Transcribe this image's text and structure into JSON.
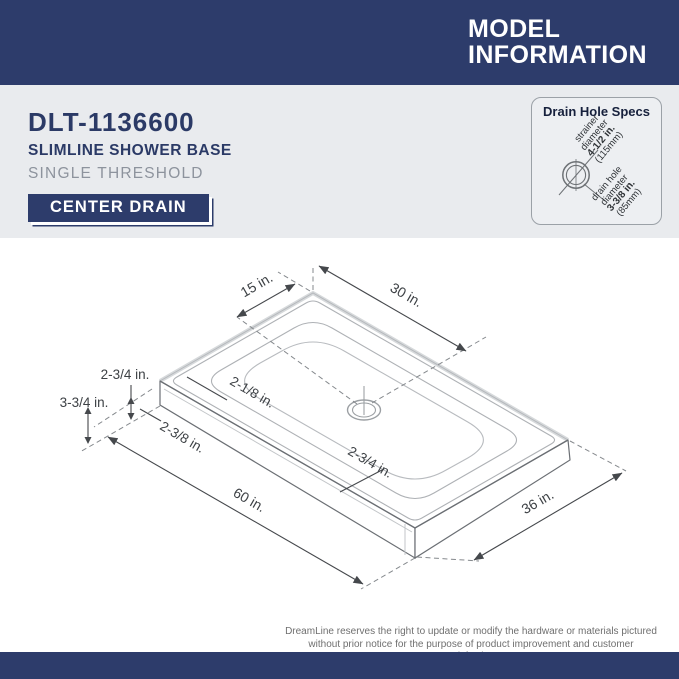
{
  "header": {
    "title_line1": "MODEL",
    "title_line2": "INFORMATION"
  },
  "product": {
    "model": "DLT-1136600",
    "name": "SLIMLINE SHOWER BASE",
    "threshold": "SINGLE THRESHOLD",
    "drain_badge": "CENTER DRAIN"
  },
  "drain_specs": {
    "title": "Drain Hole Specs",
    "strainer": {
      "line1": "strainer",
      "line2": "diameter",
      "value": "4-1/2 in.",
      "metric": "(115mm)"
    },
    "drain_hole": {
      "line1": "drain hole",
      "line2": "diameter",
      "value": "3-3/8 in.",
      "metric": "(85mm)"
    }
  },
  "diagram": {
    "dims": {
      "offset_short": "15 in.",
      "offset_long": "30 in.",
      "deck_width": "2-1/8 in.",
      "threshold_top": "2-3/4 in.",
      "threshold_height": "3-3/4 in.",
      "front_lip": "2-3/8 in.",
      "drain_to_edge": "2-3/4 in.",
      "length": "60 in.",
      "depth": "36 in."
    }
  },
  "footer": {
    "disclaimer_line1": "DreamLine reserves the right to update or modify the hardware or materials pictured",
    "disclaimer_line2": "without prior notice for the purpose of product improvement and customer satisfaction."
  },
  "colors": {
    "navy": "#2d3c6b",
    "gray_band": "#e9ebee",
    "line_gray": "#aeb1b5",
    "text_gray": "#8d939d"
  }
}
